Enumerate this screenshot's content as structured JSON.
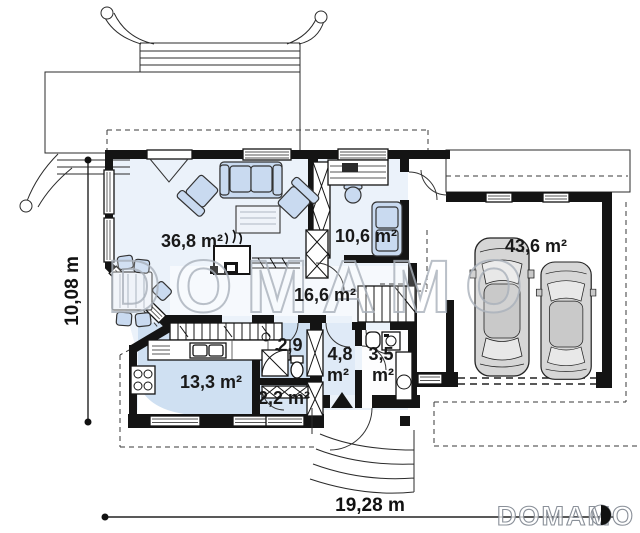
{
  "watermark": {
    "text": "DOMAMO"
  },
  "brand": {
    "logo_text": "DOMAMO"
  },
  "dimensions": {
    "height_label": "10,08 m",
    "width_label": "19,28 m"
  },
  "rooms": {
    "living_room": {
      "area_label": "36,8 m²"
    },
    "office": {
      "area_label": "10,6 m²"
    },
    "garage": {
      "area_label": "43,6 m²"
    },
    "hall": {
      "area_label": "16,6 m²"
    },
    "kitchen": {
      "area_label": "13,3 m²"
    },
    "bathroom": {
      "area_label": "2,9"
    },
    "corridor": {
      "value": "4,8",
      "unit": "m²"
    },
    "wc": {
      "value": "3,5",
      "unit": "m²"
    },
    "closet": {
      "area_label": "2,2 m²"
    }
  },
  "colors": {
    "wall": "#141414",
    "room_light": "#ebf2fa",
    "room_medium": "#cfe0f2",
    "furniture": "#c9daf0",
    "watermark_stroke": "#a9b0ba"
  }
}
